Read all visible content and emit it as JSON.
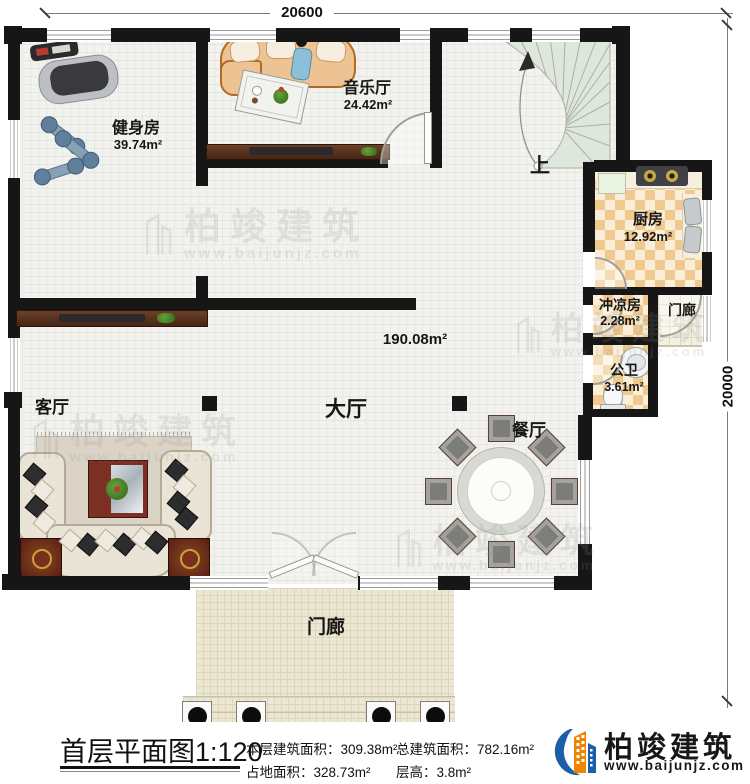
{
  "dimensions": {
    "top": "20600",
    "right": "20000"
  },
  "rooms": {
    "gym": {
      "name": "健身房",
      "area": "39.74m²"
    },
    "music": {
      "name": "音乐厅",
      "area": "24.42m²"
    },
    "stairs": {
      "up": "上"
    },
    "kitchen": {
      "name": "厨房",
      "area": "12.92m²"
    },
    "shower": {
      "name": "冲凉房",
      "area": "2.28m²"
    },
    "porch_right": {
      "name": "门廊"
    },
    "wc": {
      "name": "公卫",
      "area": "3.61m²"
    },
    "hall": {
      "name": "大厅",
      "area": "190.08m²"
    },
    "living": {
      "name": "客厅"
    },
    "dining": {
      "name": "餐厅"
    },
    "porch": {
      "name": "门廊"
    }
  },
  "footer": {
    "plan_title": "首层平面图",
    "scale": "1:120",
    "stats": [
      {
        "label": "本层建筑面积：",
        "value": "309.38m²"
      },
      {
        "label": "占地面积：",
        "value": "328.73m²"
      },
      {
        "label": "总建筑面积：",
        "value": "782.16m²"
      },
      {
        "label": "层高：",
        "value": "3.8m²"
      }
    ],
    "brand": {
      "name": "柏竣建筑",
      "url": "www.baijunjz.com"
    }
  },
  "watermark": {
    "name": "柏竣建筑",
    "url": "www.baijunjz.com"
  },
  "colors": {
    "brand_blue": "#1b5fa8",
    "brand_orange": "#f08300",
    "wall": "#161616"
  }
}
